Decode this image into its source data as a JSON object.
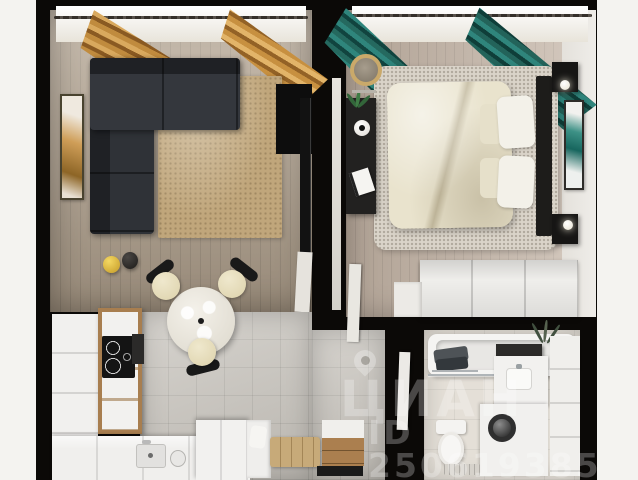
{
  "scene": {
    "description": "Photorealistic top-down 3D render of a one-bedroom apartment floor plan",
    "background_color": "#f4f3f0",
    "wall_color": "#0b0907"
  },
  "watermark": {
    "brand": "ЦИАН",
    "listing_id": "ID 250619385",
    "icon": "map-pin-icon",
    "text_color": "rgba(255,255,255,0.26)"
  },
  "palette": {
    "living_floor": "#b0a08c",
    "bedroom_floor": "#c4b4a5",
    "kitchen_tile": "#c9c5be",
    "bathroom_tile": "#e4dfd7",
    "sofa": "#2f3237",
    "living_rug": "#c0a67b",
    "bedroom_rug": "#dad4c9",
    "bed_duvet": "#e9e3cd",
    "gold_curtains": "#c08b3e",
    "teal_curtains": "#25695f",
    "wood_cabinet": "#a87e4f",
    "white_furniture": "#f1f0ee",
    "bench_cushion": "#c7aa79",
    "lamp_yellow": "#e8c23a"
  },
  "rooms": {
    "living_room": {
      "name": "living room",
      "objects": [
        "corner-sofa",
        "jute-rug",
        "gold-curtains",
        "window",
        "wall-art",
        "tv-panel",
        "yellow-lamp",
        "black-lamp"
      ]
    },
    "kitchen": {
      "name": "kitchen-dining",
      "objects": [
        "white-cabinets",
        "wood-cabinet-column",
        "induction-cooktop",
        "oven",
        "counter-with-sink",
        "kettle",
        "round-marble-table",
        "three-cream-chairs"
      ]
    },
    "hallway": {
      "name": "hallway",
      "objects": [
        "bench-with-cushion",
        "pillow",
        "shoe-cabinet",
        "white-storage-box"
      ]
    },
    "bedroom": {
      "name": "bedroom",
      "objects": [
        "double-bed",
        "pillows",
        "fluffy-rug",
        "teal-curtains",
        "window",
        "headboard",
        "nightstands",
        "wall-sconces",
        "wall-art",
        "desk-console",
        "plant",
        "vase",
        "book",
        "round-mirror",
        "wardrobe"
      ]
    },
    "bathroom": {
      "name": "bathroom",
      "objects": [
        "bathtub",
        "plant-sprigs",
        "towels",
        "shower-glass",
        "vanity-with-sink",
        "washing-machine",
        "toilet",
        "floor-drain",
        "storage-column",
        "dark-shelf"
      ]
    }
  }
}
